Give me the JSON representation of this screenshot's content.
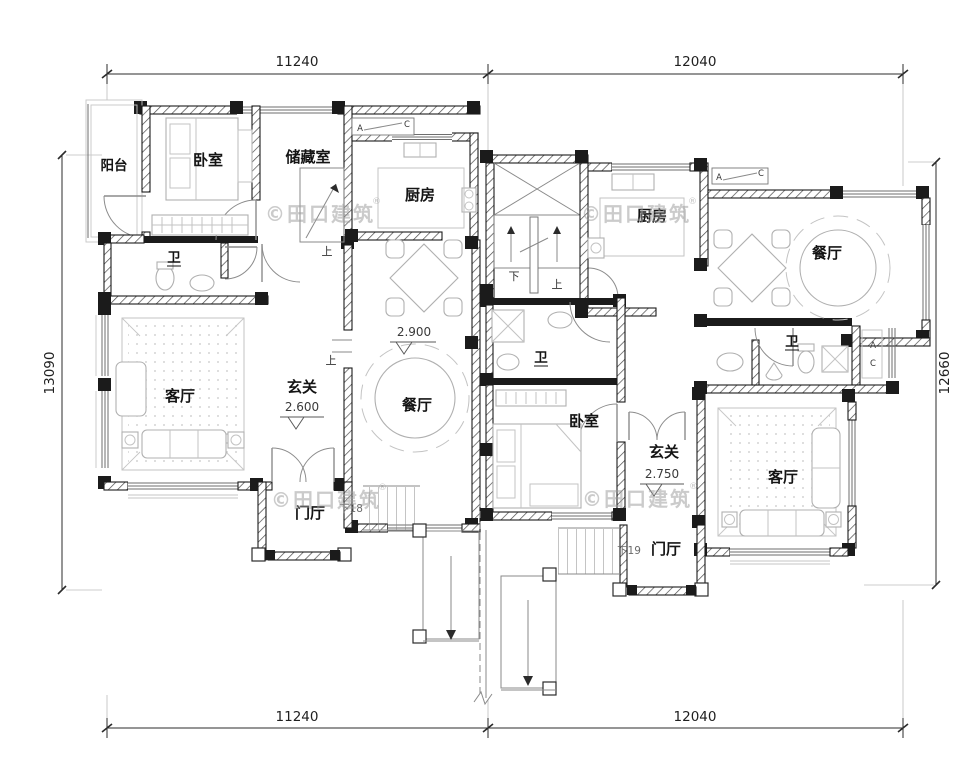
{
  "dimensions": {
    "top_left": "11240",
    "top_right": "12040",
    "bottom_left": "11240",
    "bottom_right": "12040",
    "left_side": "13090",
    "right_side": "12660"
  },
  "left_unit": {
    "balcony": "阳台",
    "bedroom": "卧室",
    "storage": "储藏室",
    "kitchen": "厨房",
    "bath": "卫",
    "living": "客厅",
    "entry": "玄关",
    "entry_level": "2.600",
    "dining": "餐厅",
    "dining_level": "2.900",
    "foyer": "门厅",
    "foyer_steps": "下18"
  },
  "right_unit": {
    "kitchen": "厨房",
    "dining": "餐厅",
    "bath_main": "卫",
    "bath_inner": "卫",
    "bedroom": "卧室",
    "entry": "玄关",
    "entry_level": "2.750",
    "living": "客厅",
    "foyer": "门厅",
    "foyer_steps": "下19"
  },
  "stairs": {
    "up": "上",
    "down": "下"
  },
  "window_tag": {
    "a": "A",
    "c": "C"
  },
  "watermark": {
    "text": "©田口建筑",
    "reg": "®"
  },
  "colors": {
    "wall": "#1b1b1b",
    "furniture": "#b0b0b0",
    "dimension": "#2b2b2b",
    "watermark": "#9c9c9c"
  }
}
